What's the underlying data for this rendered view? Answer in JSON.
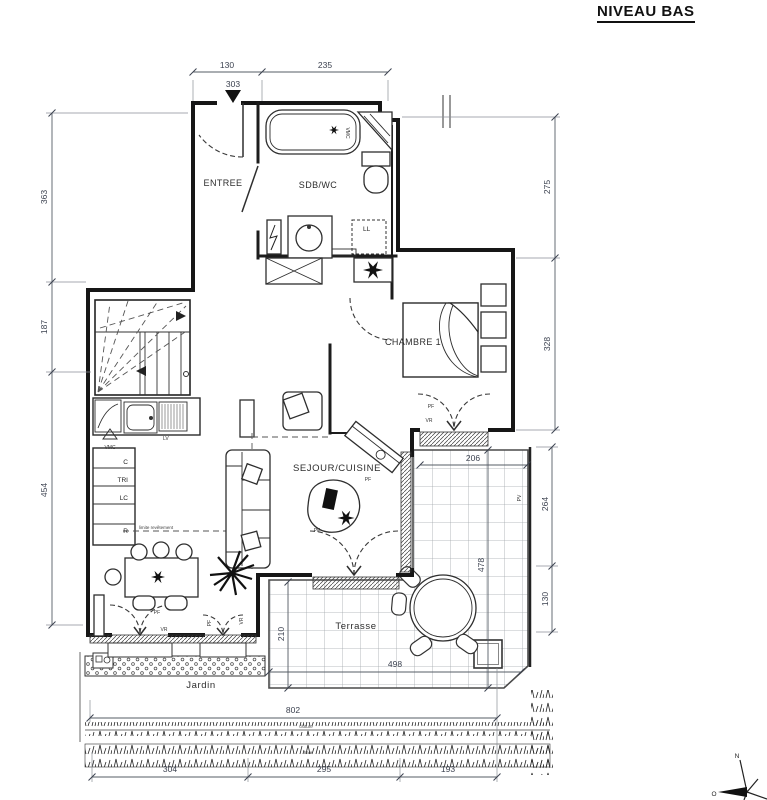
{
  "title": "NIVEAU BAS",
  "rooms": {
    "entree": "ENTREE",
    "sdb_wc": "SDB/WC",
    "chambre": "CHAMBRE 1",
    "sejour_cuisine": "SEJOUR/CUISINE",
    "terrasse": "Terrasse",
    "jardin": "Jardin"
  },
  "dimensions": {
    "top_130": "130",
    "top_235": "235",
    "entry_303": "303",
    "left_363": "363",
    "left_187": "187",
    "left_454": "454",
    "right_275": "275",
    "right_328": "328",
    "terrace_206": "206",
    "terrace_264": "264",
    "terrace_130": "130",
    "terrace_478": "478",
    "terrace_210": "210",
    "terrace_498": "498",
    "total_802": "802",
    "bottom_304": "304",
    "bottom_295": "295",
    "bottom_193": "193"
  },
  "annotations": {
    "vmc": "VMC",
    "ll": "LL",
    "lv": "LV",
    "c": "C",
    "tri": "TRI",
    "lc": "LC",
    "r": "R",
    "pf": "PF",
    "vr": "VR",
    "pv": "PV",
    "limite_revetement": "limite revêtement",
    "cloture": "clôture",
    "haie": "haie"
  },
  "compass": {
    "north": "N",
    "west": "O"
  }
}
